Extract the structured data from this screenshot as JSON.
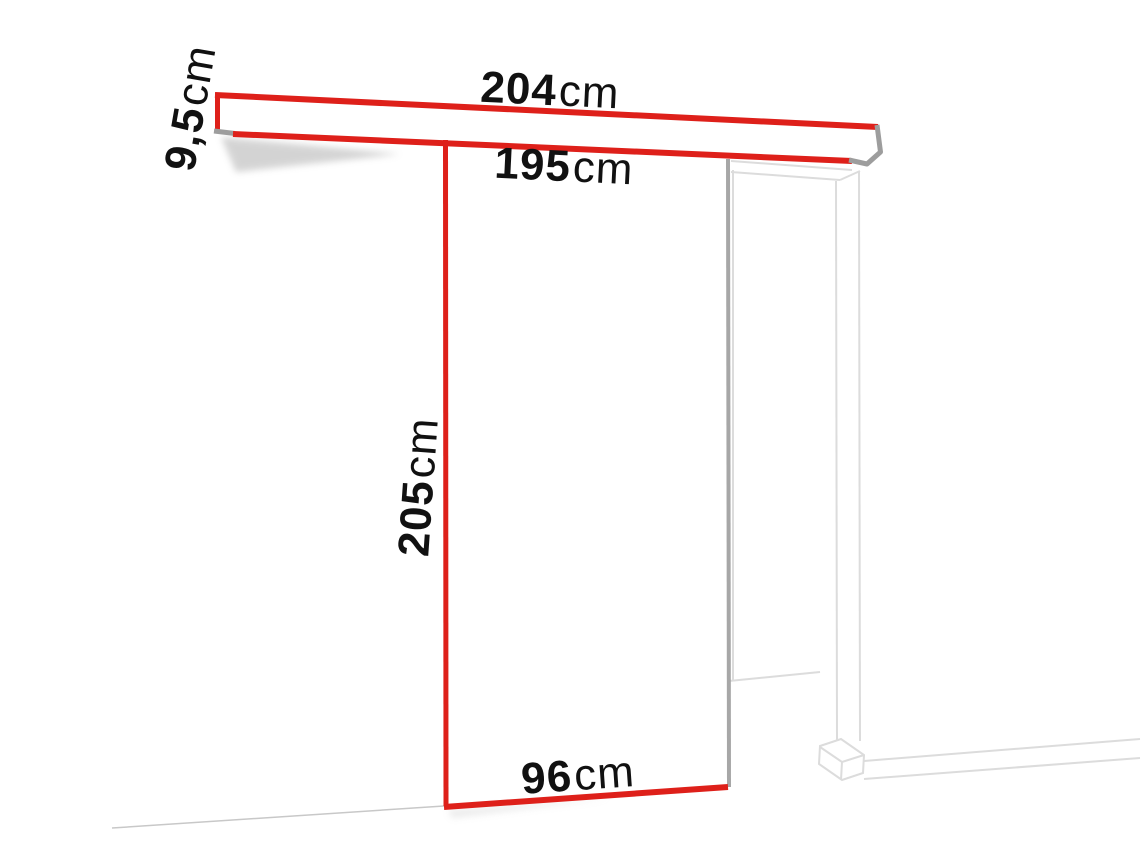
{
  "diagram": {
    "labels": {
      "rail_length": {
        "value": "204",
        "unit": "cm"
      },
      "rail_profile_height": {
        "value": "9,5",
        "unit": "cm"
      },
      "track_length": {
        "value": "195",
        "unit": "cm"
      },
      "door_height": {
        "value": "205",
        "unit": "cm"
      },
      "door_width": {
        "value": "96",
        "unit": "cm"
      }
    },
    "colors": {
      "dimension_red": "#de201a",
      "hardware_gray": "#9d9d9d",
      "door_edge_gray": "#a7a7a7",
      "frame_line_gray": "#dcdcdc",
      "floor_line_gray": "#c8c8c8",
      "label_text": "#111111",
      "background": "#ffffff"
    }
  }
}
